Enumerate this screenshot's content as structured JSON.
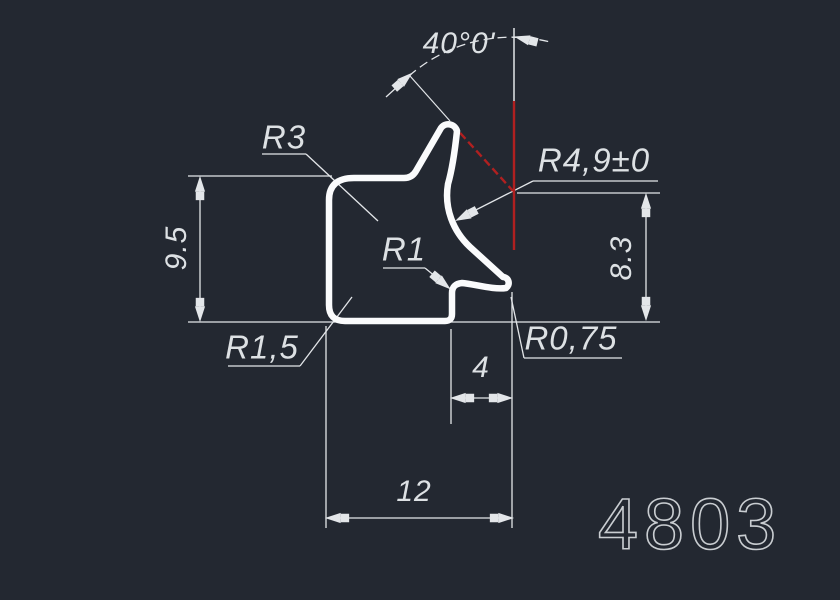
{
  "drawing": {
    "title": "extrusion-profile-cross-section",
    "part_number": "4803",
    "labels": {
      "angle": "40°0'",
      "r3": "R3",
      "r49": "R4,9±0",
      "height_left": "9.5",
      "height_right": "8.3",
      "r1": "R1",
      "r15": "R1,5",
      "r075": "R0,75",
      "width_inner": "4",
      "width_total": "12"
    },
    "colors": {
      "background": "#232831",
      "thin_lines": "#e3e6e9",
      "profile_outline": "#fafbfc",
      "construction_red": "#b02020",
      "text": "#dde1e4"
    }
  }
}
